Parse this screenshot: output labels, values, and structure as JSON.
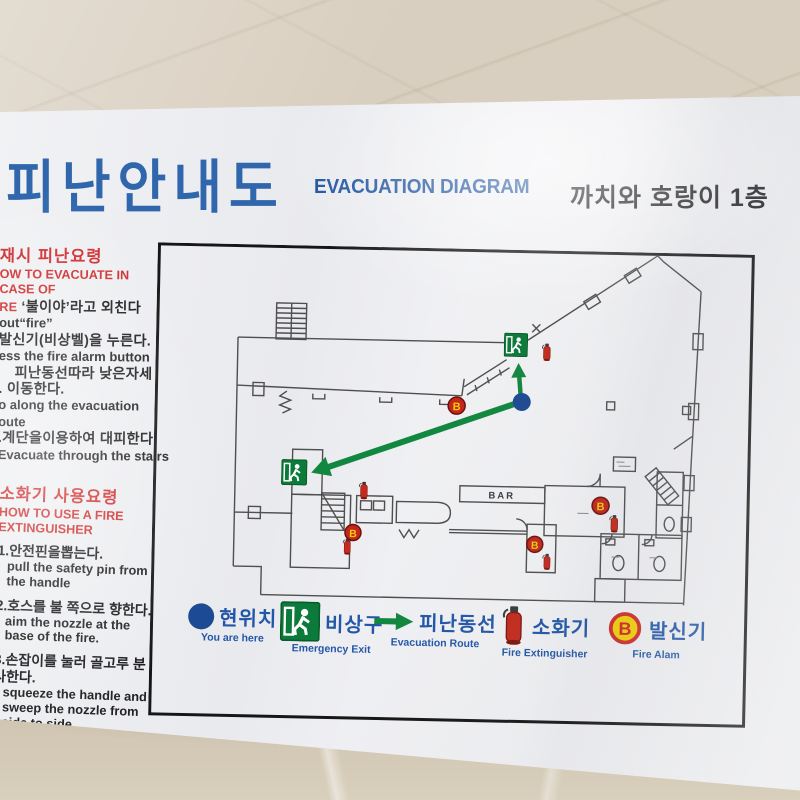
{
  "header": {
    "title_ko": "피난안내도",
    "title_en": "EVACUATION DIAGRAM",
    "location": "까치와 호랑이 1층"
  },
  "sidebar": {
    "evac": {
      "heading_ko": "재시 피난요령",
      "heading_en": "OW TO EVACUATE IN CASE OF",
      "lines": [
        {
          "red": "RE",
          "text": "‘불이야’라고  외친다"
        },
        {
          "text": "out“fire”"
        },
        {
          "text": "발신기(비상벨)을 누른다."
        },
        {
          "text": "ess the fire alarm button"
        },
        {
          "text": "피난동선따라  낮은자세"
        },
        {
          "text": ". 이동한다."
        },
        {
          "text": "o along the evacuation"
        },
        {
          "text": "oute"
        },
        {
          "text": ".계단을이용하여 대피한다."
        },
        {
          "text": "Evacuate through the stairs"
        }
      ]
    },
    "ext": {
      "heading_ko": "소화기 사용요령",
      "heading_en1": "HOW TO USE A FIRE",
      "heading_en2": "EXTINGUISHER",
      "steps": [
        {
          "ko": "1.안전핀을뽑는다.",
          "en": "pull the safety pin from the handle"
        },
        {
          "ko": "2.호스를 불 쪽으로 향한다.",
          "en": "aim the nozzle at the base of the fire."
        },
        {
          "ko": "3.손잡이를 눌러 골고루 분사한다.",
          "en": "squeeze the handle and sweep the nozzle from side to side."
        }
      ]
    }
  },
  "legend": {
    "items": [
      {
        "ko": "현위치",
        "en": "You are here"
      },
      {
        "ko": "비상구",
        "en": "Emergency Exit"
      },
      {
        "ko": "피난동선",
        "en": "Evacuation Route"
      },
      {
        "ko": "소화기",
        "en": "Fire Extinguisher"
      },
      {
        "ko": "발신기",
        "en": "Fire Alam",
        "badge": "B"
      }
    ]
  },
  "floor_plan": {
    "bar_label": "BAR",
    "alarm_badge": "B"
  },
  "colors": {
    "title_blue": "#2f66ac",
    "legend_blue": "#2257a8",
    "accent_red": "#d02d2d",
    "route_green": "#12873f",
    "exit_green": "#0c7a3a",
    "alarm_yellow": "#f3d003",
    "alarm_ring_red": "#cf2a26",
    "extinguisher_red": "#c62a1c",
    "marker_blue": "#1d4a94"
  }
}
